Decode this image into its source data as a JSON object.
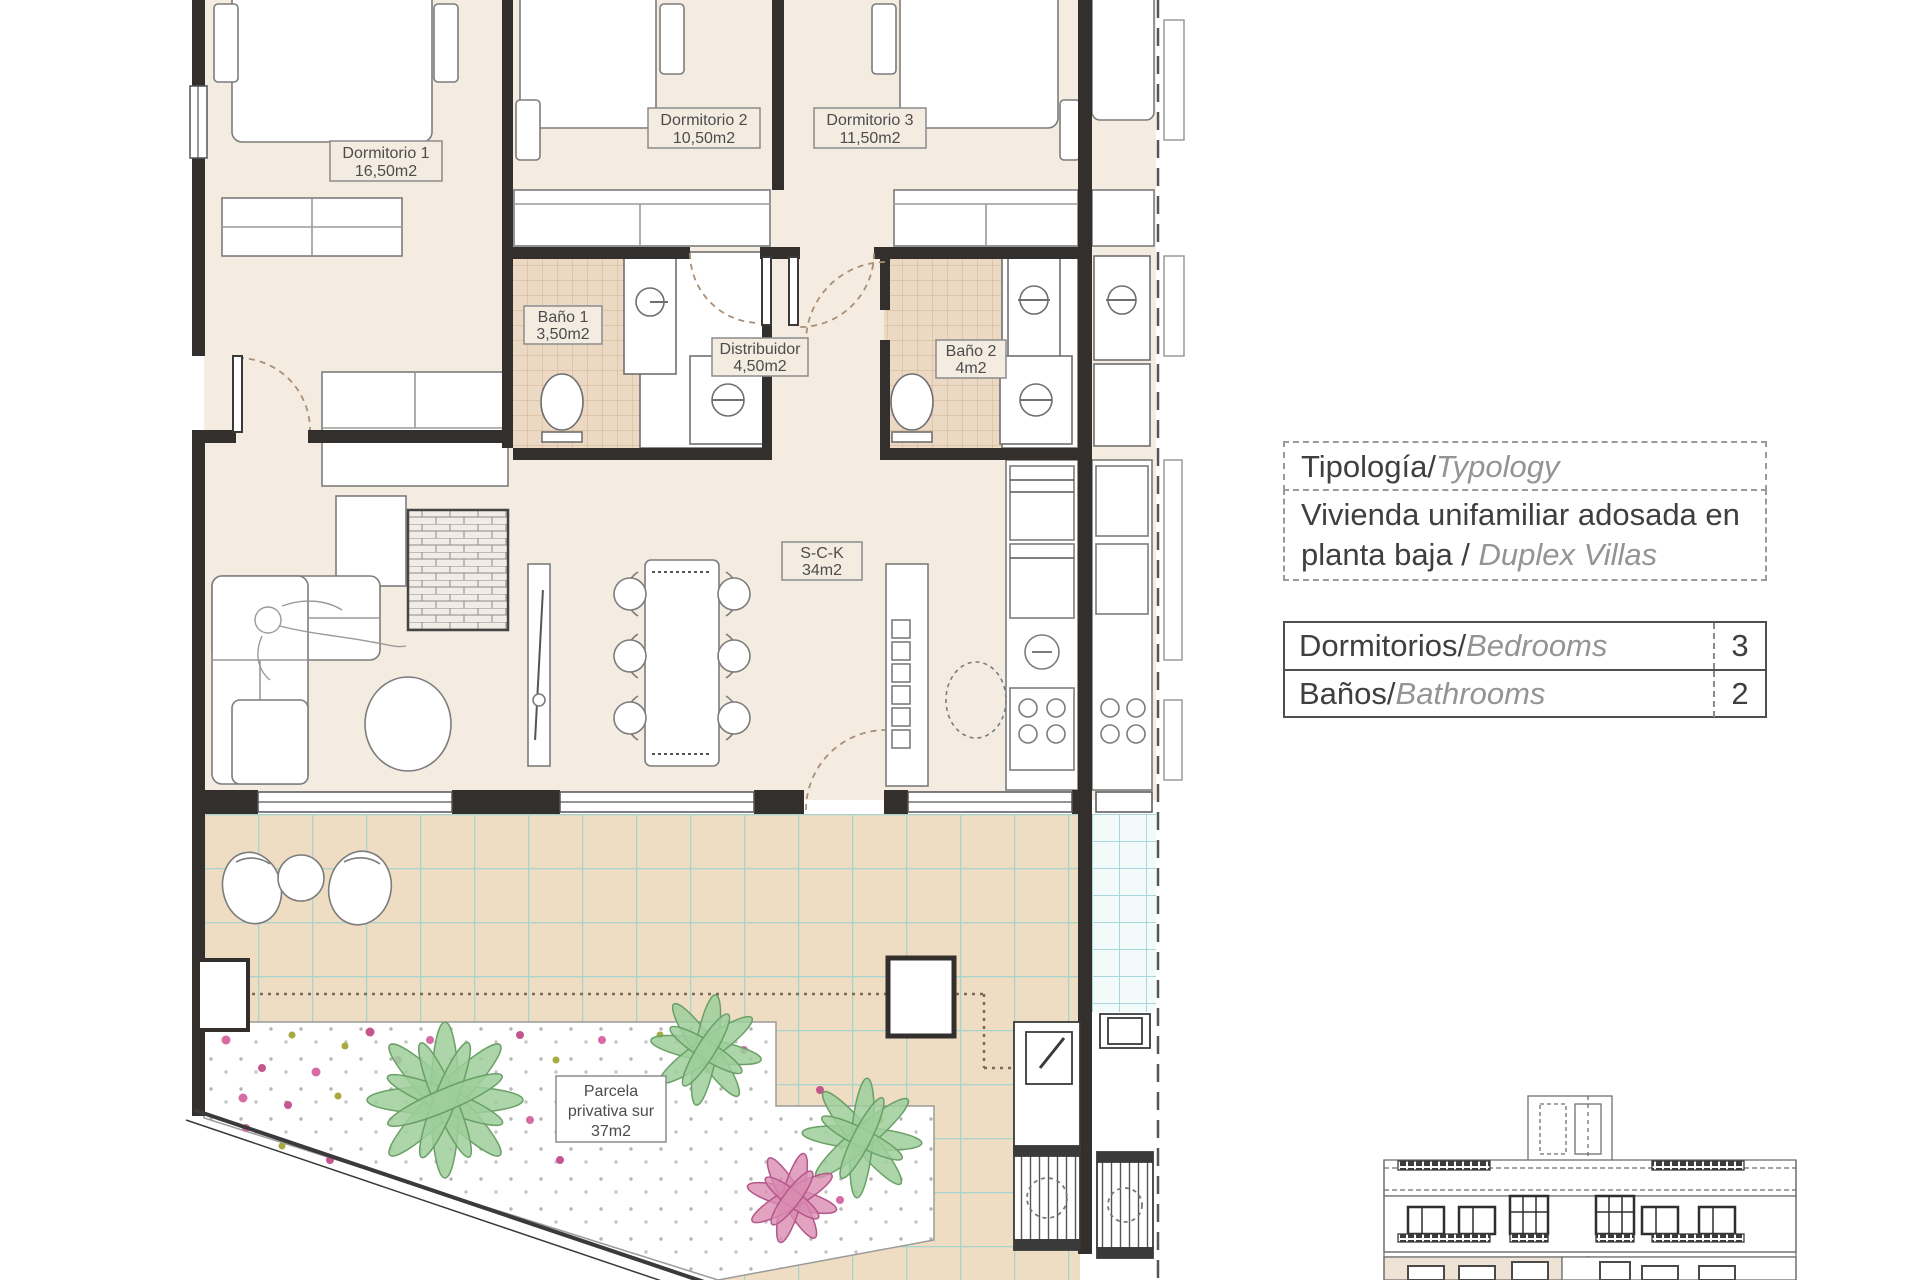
{
  "panel": {
    "typology": {
      "label_primary": "Tipología/",
      "label_secondary": "Typology",
      "value_primary": "Vivienda unifamiliar adosada en planta baja / ",
      "value_secondary": "Duplex Villas"
    },
    "specs": [
      {
        "label_primary": "Dormitorios/",
        "label_secondary": "Bedrooms",
        "value": "3"
      },
      {
        "label_primary": "Baños/",
        "label_secondary": "Bathrooms",
        "value": "2"
      }
    ]
  },
  "plan": {
    "rooms": {
      "d1": {
        "l1": "Dormitorio 1",
        "l2": "16,50m2"
      },
      "d2": {
        "l1": "Dormitorio 2",
        "l2": "10,50m2"
      },
      "d3": {
        "l1": "Dormitorio 3",
        "l2": "11,50m2"
      },
      "bano1": {
        "l1": "Baño 1",
        "l2": "3,50m2"
      },
      "dist": {
        "l1": "Distribuidor",
        "l2": "4,50m2"
      },
      "bano2": {
        "l1": "Baño 2",
        "l2": "4m2"
      },
      "sck": {
        "l1": "S-C-K",
        "l2": "34m2"
      },
      "parcela": {
        "l1": "Parcela",
        "l2": "privativa sur",
        "l3": "37m2"
      }
    },
    "colors": {
      "floor": "#f5ece1",
      "wall": "#332f2c",
      "terrace_tile": "#eeddc2",
      "terrace_grout": "#a6d3cd",
      "bath_tile": "#ecd9c4",
      "plant_green": "#9ecf9b",
      "flower_pink": "#d66ba6",
      "elevation_highlight": "#efe3d6"
    }
  }
}
